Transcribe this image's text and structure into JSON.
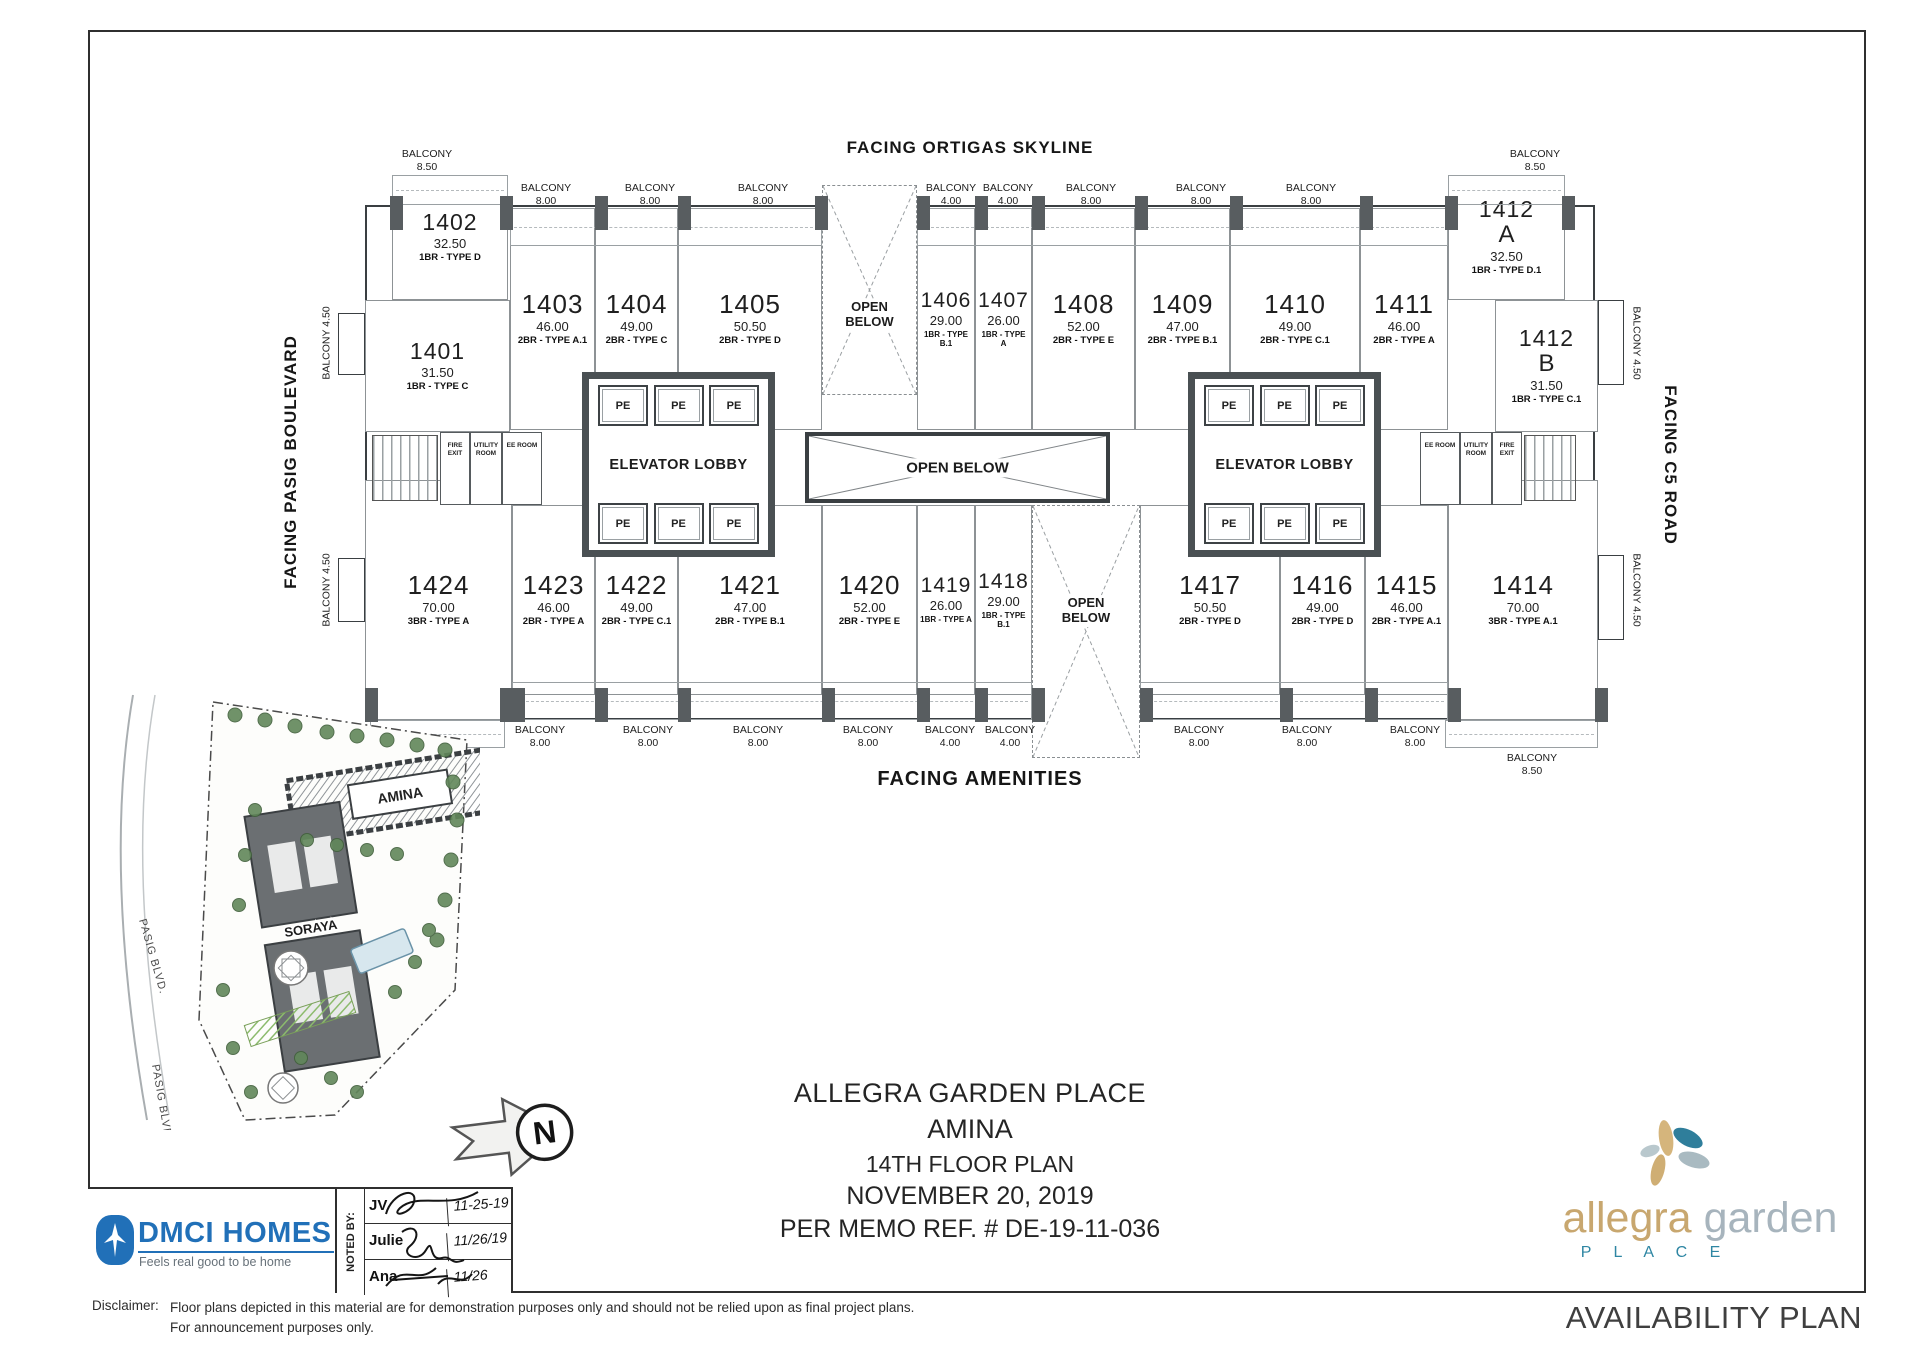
{
  "facing": {
    "top": "FACING ORTIGAS SKYLINE",
    "bottom": "FACING AMENITIES",
    "left": "FACING PASIG BOULEVARD",
    "right": "FACING C5 ROAD"
  },
  "plan": {
    "open_below": "OPEN BELOW",
    "elevator_lobby": "ELEVATOR LOBBY",
    "pe": "PE",
    "fire_exit": "FIRE EXIT",
    "utility_room": "UTILITY ROOM",
    "ee_room": "EE ROOM",
    "units": [
      {
        "number": "1401",
        "area": "31.50",
        "type": "1BR - TYPE C"
      },
      {
        "number": "1402",
        "area": "32.50",
        "type": "1BR - TYPE D"
      },
      {
        "number": "1403",
        "area": "46.00",
        "type": "2BR - TYPE A.1"
      },
      {
        "number": "1404",
        "area": "49.00",
        "type": "2BR - TYPE C"
      },
      {
        "number": "1405",
        "area": "50.50",
        "type": "2BR - TYPE D"
      },
      {
        "number": "1406",
        "area": "29.00",
        "type": "1BR - TYPE B.1"
      },
      {
        "number": "1407",
        "area": "26.00",
        "type": "1BR - TYPE A"
      },
      {
        "number": "1408",
        "area": "52.00",
        "type": "2BR - TYPE E"
      },
      {
        "number": "1409",
        "area": "47.00",
        "type": "2BR - TYPE B.1"
      },
      {
        "number": "1410",
        "area": "49.00",
        "type": "2BR - TYPE C.1"
      },
      {
        "number": "1411",
        "area": "46.00",
        "type": "2BR - TYPE A"
      },
      {
        "number": "1412",
        "suffix": "A",
        "area": "32.50",
        "type": "1BR - TYPE D.1"
      },
      {
        "number": "1412",
        "suffix": "B",
        "area": "31.50",
        "type": "1BR - TYPE C.1"
      },
      {
        "number": "1414",
        "area": "70.00",
        "type": "3BR - TYPE A.1"
      },
      {
        "number": "1415",
        "area": "46.00",
        "type": "2BR - TYPE A.1"
      },
      {
        "number": "1416",
        "area": "49.00",
        "type": "2BR - TYPE D"
      },
      {
        "number": "1417",
        "area": "50.50",
        "type": "2BR - TYPE D"
      },
      {
        "number": "1418",
        "area": "29.00",
        "type": "1BR - TYPE B.1"
      },
      {
        "number": "1419",
        "area": "26.00",
        "type": "1BR - TYPE A"
      },
      {
        "number": "1420",
        "area": "52.00",
        "type": "2BR - TYPE E"
      },
      {
        "number": "1421",
        "area": "47.00",
        "type": "2BR - TYPE B.1"
      },
      {
        "number": "1422",
        "area": "49.00",
        "type": "2BR - TYPE C.1"
      },
      {
        "number": "1423",
        "area": "46.00",
        "type": "2BR - TYPE A"
      },
      {
        "number": "1424",
        "area": "70.00",
        "type": "3BR - TYPE A"
      }
    ],
    "balconies": [
      {
        "label": "BALCONY",
        "value": "8.50"
      },
      {
        "label": "BALCONY",
        "value": "8.00"
      },
      {
        "label": "BALCONY",
        "value": "8.00"
      },
      {
        "label": "BALCONY",
        "value": "8.00"
      },
      {
        "label": "BALCONY",
        "value": "4.00"
      },
      {
        "label": "BALCONY",
        "value": "4.00"
      },
      {
        "label": "BALCONY",
        "value": "8.00"
      },
      {
        "label": "BALCONY",
        "value": "8.00"
      },
      {
        "label": "BALCONY",
        "value": "8.00"
      },
      {
        "label": "BALCONY",
        "value": "8.50"
      },
      {
        "label": "BALCONY 4.50",
        "value": ""
      },
      {
        "label": "BALCONY 4.50",
        "value": ""
      },
      {
        "label": "BALCONY 4.50",
        "value": ""
      },
      {
        "label": "BALCONY 4.50",
        "value": ""
      },
      {
        "label": "BALCONY",
        "value": "8.50"
      },
      {
        "label": "BALCONY",
        "value": "8.00"
      },
      {
        "label": "BALCONY",
        "value": "8.00"
      },
      {
        "label": "BALCONY",
        "value": "8.00"
      },
      {
        "label": "BALCONY",
        "value": "8.00"
      },
      {
        "label": "BALCONY",
        "value": "4.00"
      },
      {
        "label": "BALCONY",
        "value": "4.00"
      },
      {
        "label": "BALCONY",
        "value": "8.00"
      },
      {
        "label": "BALCONY",
        "value": "8.00"
      },
      {
        "label": "BALCONY",
        "value": "8.00"
      },
      {
        "label": "BALCONY",
        "value": "8.50"
      }
    ]
  },
  "site": {
    "amina": "AMINA",
    "soraya": "SORAYA",
    "road1": "PASIG BLVD.",
    "road2": "PASIG BLVD.",
    "north": "N"
  },
  "title_block": {
    "line1": "ALLEGRA GARDEN PLACE",
    "line2": "AMINA",
    "line3": "14TH FLOOR PLAN",
    "line4": "NOVEMBER 20, 2019",
    "line5": "PER MEMO REF. # DE-19-11-036",
    "noted_by": "NOTED BY:",
    "signatories": [
      {
        "name": "JV",
        "date": "11-25-19"
      },
      {
        "name": "Julie",
        "date": "11/26/19"
      },
      {
        "name": "Ana",
        "date": "11/26"
      }
    ],
    "dmci_name": "DMCI HOMES",
    "dmci_tagline": "Feels real good to be home",
    "brand_word1": "allegra",
    "brand_word2": "garden",
    "brand_place": "P L A C E",
    "availability": "AVAILABILITY PLAN",
    "disclaimer_label": "Disclaimer:",
    "disclaimer_line1": "Floor plans depicted in this material are for demonstration purposes only and should not be relied upon as final project plans.",
    "disclaimer_line2": "For announcement purposes only."
  },
  "colors": {
    "ink": "#2a2a2a",
    "wall": "#3a3f42",
    "column": "#585d60",
    "dmci_blue": "#2170b8",
    "brand_gold": "#c8a76f",
    "brand_gray": "#a7b4bd",
    "brand_teal": "#2e86a3"
  }
}
